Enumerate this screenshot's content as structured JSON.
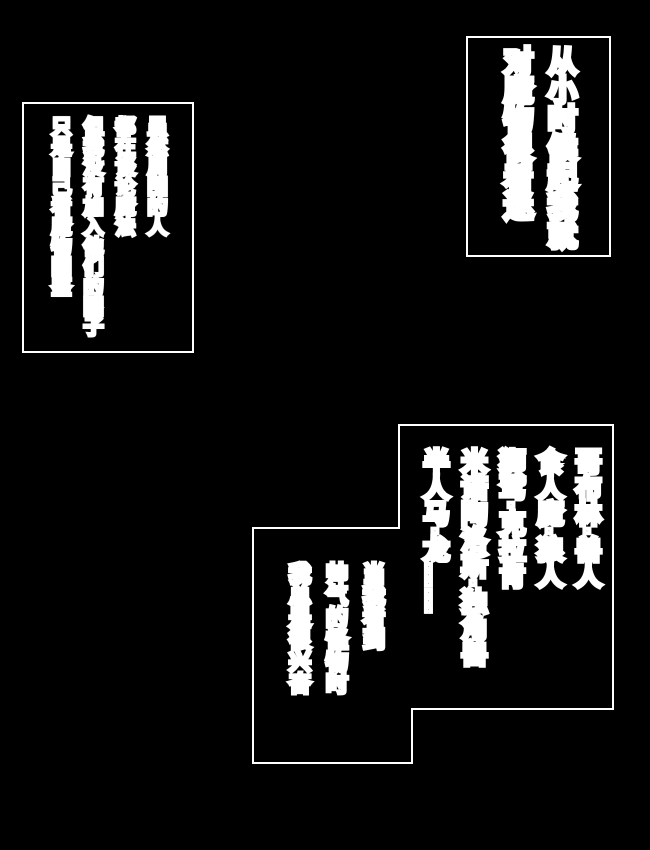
{
  "page": {
    "background_color": "#000000",
    "line_color": "#ffffff",
    "text_fill_color": "#000000",
    "text_outline_color": "#ffffff"
  },
  "bubbles": {
    "childhood": {
      "lines": [
        "从小时候起我就",
        "对魔物很着迷"
      ]
    },
    "surroundings": {
      "lines": [
        "虽然周围的人",
        "都在谈论魔法",
        "但我没有加入他们的圈子",
        "只是自己看魔物图鉴"
      ]
    },
    "monster_list": {
      "lines": [
        "哥布林·兽人",
        "食人魔·狼人",
        "狮鹫·克拉肯",
        "米诺陶洛斯·独角兽",
        "半人马·龙……"
      ]
    },
    "excitement": {
      "lines": [
        "当我看到",
        "帅气的怪物时",
        "我总是很兴奋"
      ]
    }
  }
}
